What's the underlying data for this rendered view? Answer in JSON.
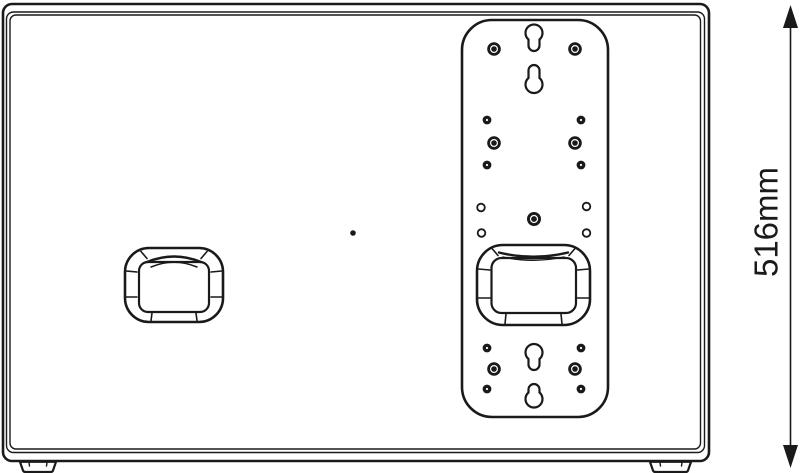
{
  "dimension": {
    "label": "516mm"
  },
  "colors": {
    "line": "#1a1a1a",
    "background": "#ffffff"
  }
}
